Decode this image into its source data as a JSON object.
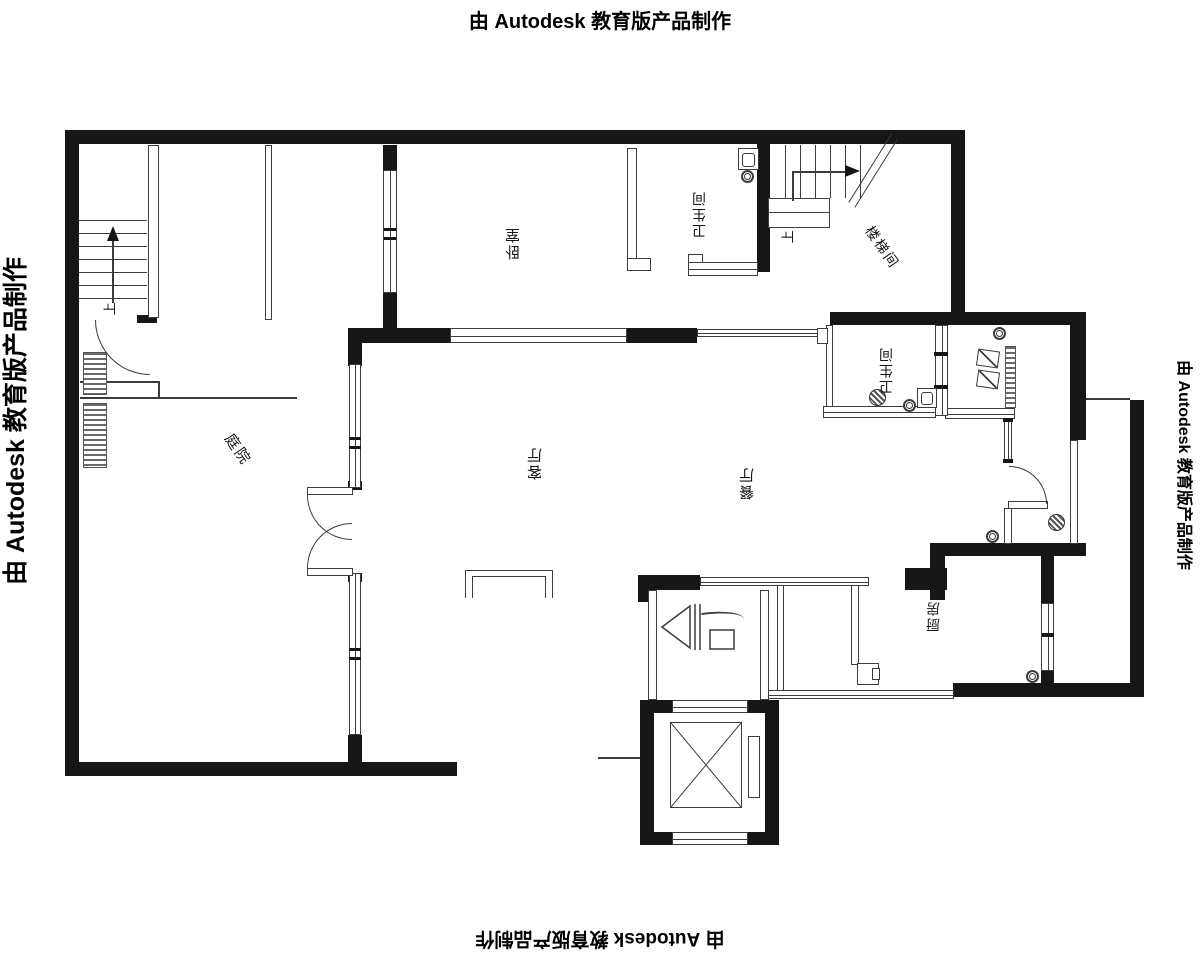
{
  "watermark": {
    "text": "由 Autodesk 教育版产品制作"
  },
  "rooms": {
    "bedroom": "卧室",
    "bathroom_top": "卫生间",
    "stairwell": "楼梯间",
    "courtyard": "庭院",
    "living_room": "客厅",
    "dining_room": "餐厅",
    "bathroom_right": "卫生间",
    "kitchen": "厨房"
  },
  "annotations": {
    "stairs_up_left": "上",
    "stairs_up_right": "上"
  },
  "colors": {
    "wall": "#161616",
    "line": "#3c3c3c",
    "background": "#ffffff"
  }
}
